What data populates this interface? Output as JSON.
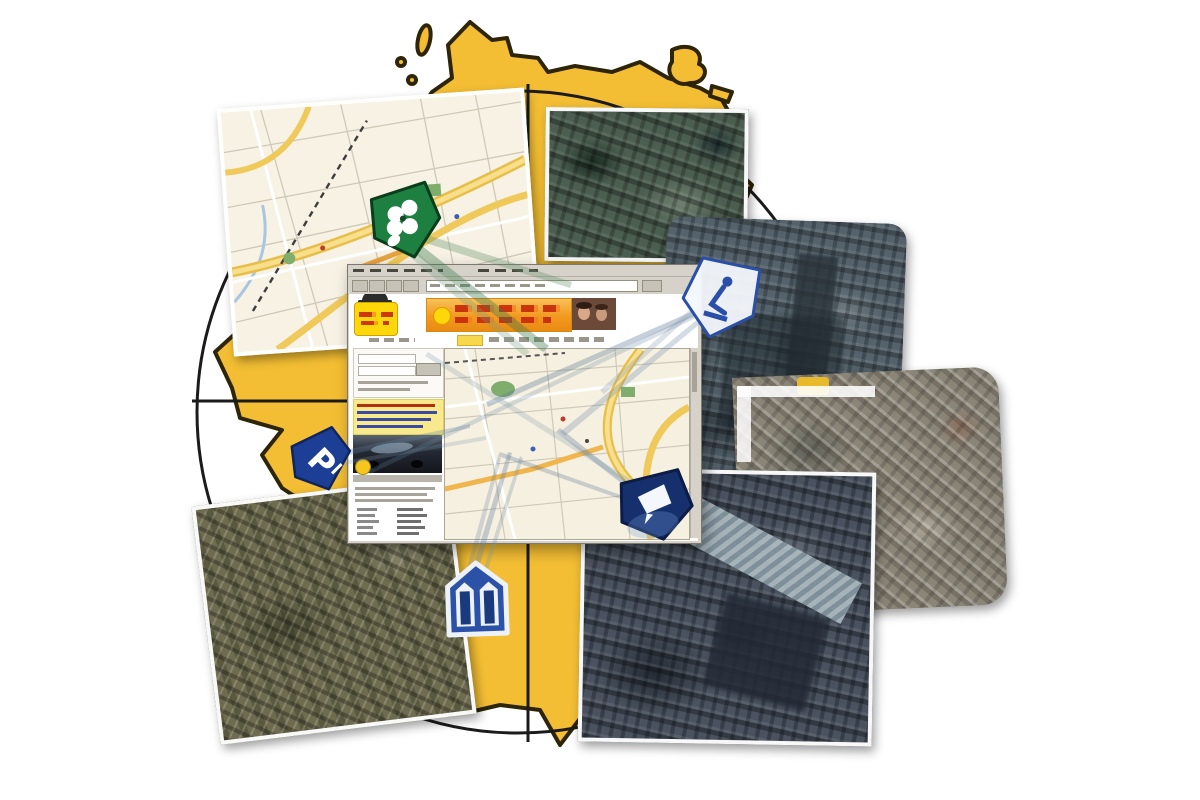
{
  "scene": {
    "kind": "map-service-collage",
    "background": "#FFFFFF"
  },
  "germany": {
    "fill": "#F3BE33",
    "outline": "#2E2507"
  },
  "compass": {
    "ring_color": "#1B1B1B"
  },
  "tiles": [
    {
      "id": "city-street-map-tile",
      "kind": "street-map"
    },
    {
      "id": "aerial-tile-north",
      "kind": "aerial-photo"
    },
    {
      "id": "aerial-tile-east-upper",
      "kind": "aerial-photo"
    },
    {
      "id": "aerial-tile-east",
      "kind": "aerial-photo"
    },
    {
      "id": "aerial-tile-southwest",
      "kind": "aerial-photo"
    },
    {
      "id": "aerial-tile-south",
      "kind": "aerial-photo"
    }
  ],
  "browser": {
    "chrome_color": "#D6D2CA",
    "logo_color": "#FFD70A",
    "banner_color": "#F29A1F",
    "map_background": "#F6F0E0",
    "road_color": "#EFC95A"
  },
  "markers": [
    {
      "id": "park-marker",
      "color": "#1E8040",
      "glyph": "flower"
    },
    {
      "id": "parking-marker",
      "color": "#1C3E94",
      "glyph": "P"
    },
    {
      "id": "monument-marker",
      "color": "#2A4FA8",
      "glyph": "statue"
    },
    {
      "id": "building-marker",
      "color": "#16306E",
      "glyph": "building"
    },
    {
      "id": "cathedral-marker",
      "color": "#2B52A6",
      "glyph": "twin-towers"
    }
  ],
  "beams": {
    "blue": "rgba(110,140,165,0.35)",
    "green": "rgba(85,140,100,0.35)"
  }
}
